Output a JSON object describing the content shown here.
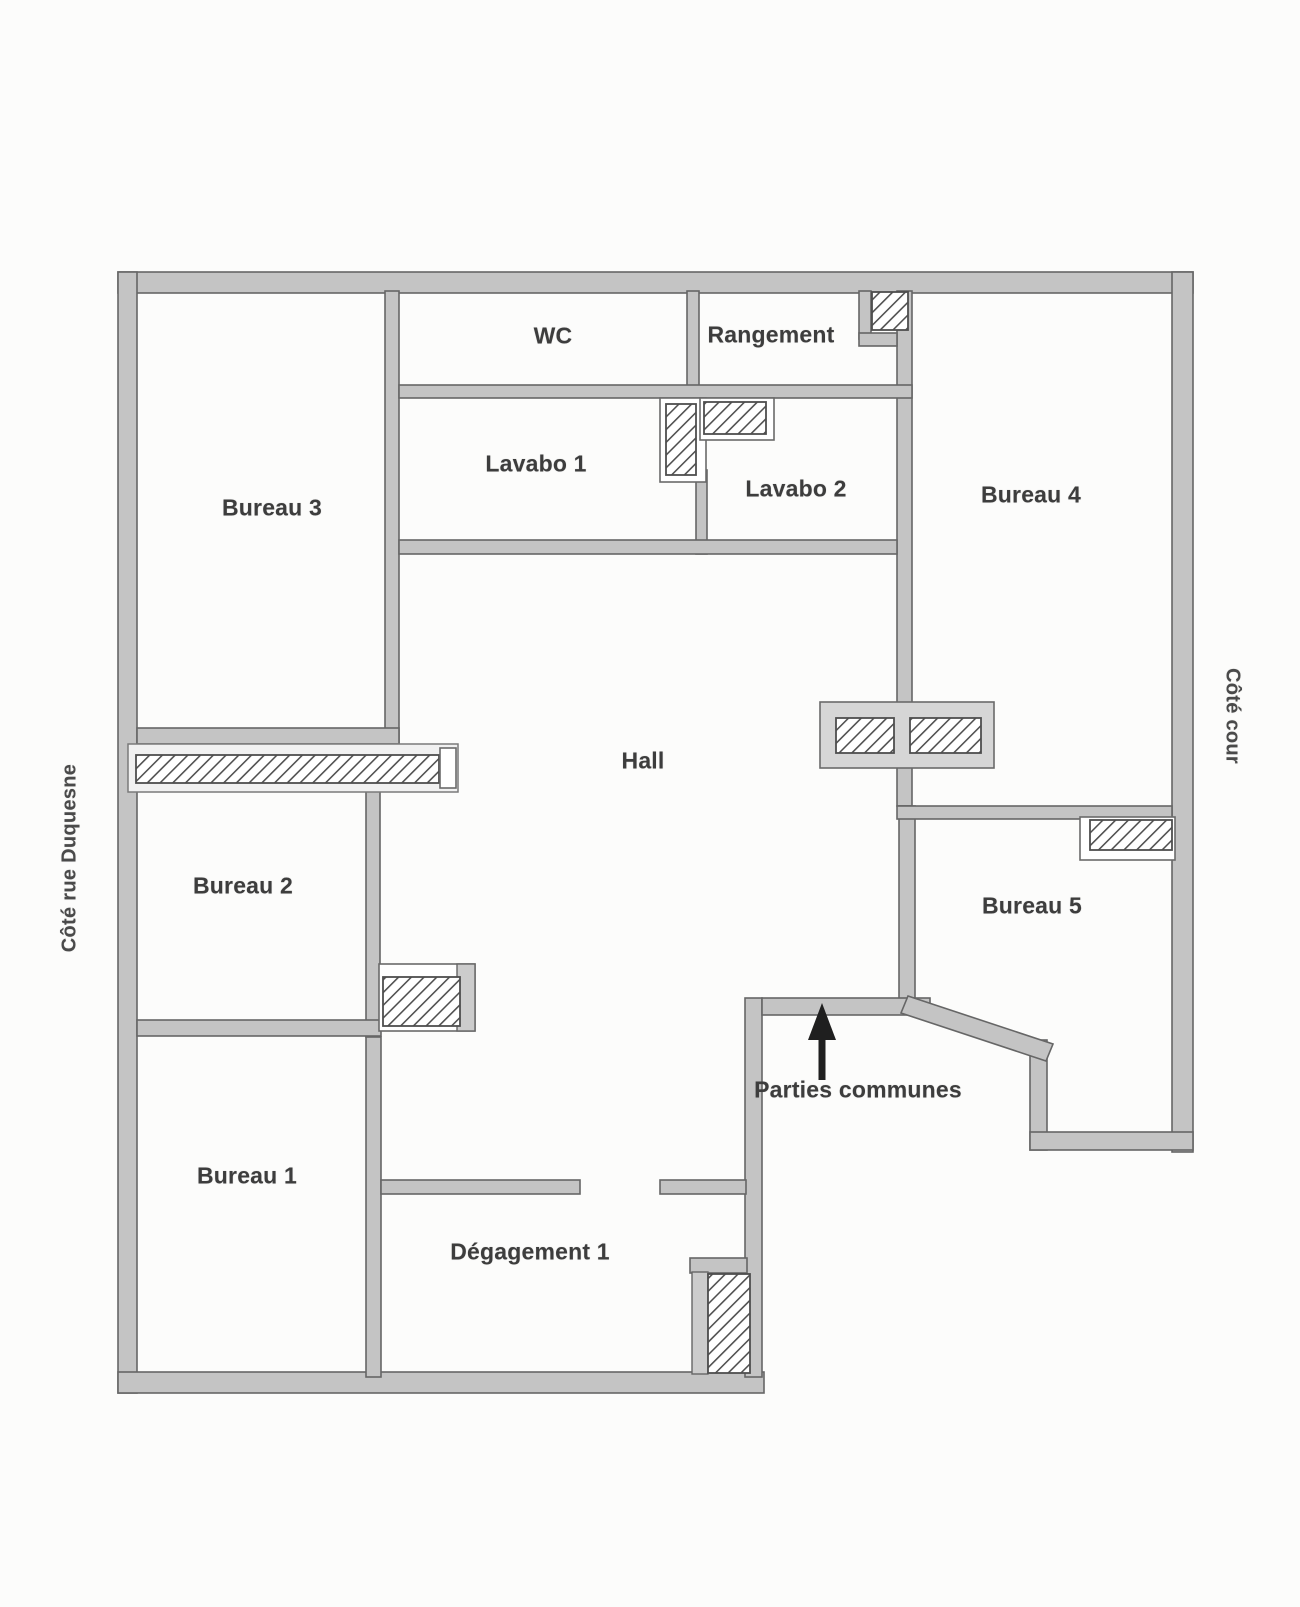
{
  "rooms": {
    "bureau1": "Bureau 1",
    "bureau2": "Bureau 2",
    "bureau3": "Bureau 3",
    "bureau4": "Bureau 4",
    "bureau5": "Bureau 5",
    "wc": "WC",
    "rangement": "Rangement",
    "lavabo1": "Lavabo 1",
    "lavabo2": "Lavabo 2",
    "hall": "Hall",
    "degagement1": "Dégagement 1"
  },
  "annotations": {
    "parties_communes": "Parties communes",
    "cote_rue_duquesne": "Côté rue Duquesne",
    "cote_cour": "Côté cour"
  },
  "colors": {
    "wall_fill": "#c4c4c4",
    "wall_edge": "#666666",
    "hatch_stroke": "#4f4f4f",
    "label_text": "#3d3d3d",
    "arrow": "#1f1f1f"
  }
}
